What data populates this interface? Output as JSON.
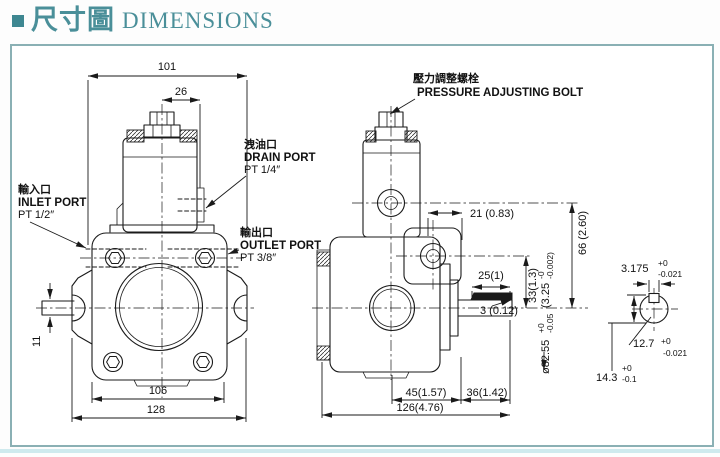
{
  "title": {
    "cjk": "尺寸圖",
    "en": "DIMENSIONS"
  },
  "front_view": {
    "dims": {
      "top_width": "101",
      "valve_offset": "26",
      "shaft_width": "11",
      "body_width": "106",
      "overall_width": "128"
    },
    "labels": {
      "drain": {
        "cjk": "洩油口",
        "en": "DRAIN PORT",
        "thread": "PT 1/4″"
      },
      "inlet": {
        "cjk": "輸入口",
        "en": "INLET PORT",
        "thread": "PT 1/2″"
      },
      "outlet": {
        "cjk": "輸出口",
        "en": "OUTLET PORT",
        "thread": "PT 3/8″"
      }
    }
  },
  "side_view": {
    "labels": {
      "pressure_bolt": {
        "cjk": "壓力調整螺栓",
        "en": "PRESSURE ADJUSTING BOLT"
      }
    },
    "dims": {
      "boss_width": "21 (0.83)",
      "valve_center_height": "66 (2.60)",
      "outlet_center_height": "33(1.3)",
      "key_length": "25(1)",
      "key_height": "3 (0.12)",
      "spigot_dia": {
        "metric": "ø82.55",
        "tol_plus": "+0",
        "tol_minus": "-0.05",
        "inch": "(3.25",
        "inch_tol_plus": "-0",
        "inch_tol_minus": "-0.002)"
      },
      "center_to_flange": "45(1.57)",
      "flange_to_shaft_end": "36(1.42)",
      "overall_length": "126(4.76)"
    }
  },
  "shaft_detail": {
    "key_width": {
      "value": "3.175",
      "tol_plus": "+0",
      "tol_minus": "-0.021"
    },
    "shaft_dia": {
      "value": "12.7",
      "tol_plus": "+0",
      "tol_minus": "-0.021"
    },
    "key_height": {
      "value": "14.3",
      "tol_plus": "+0",
      "tol_minus": "-0.1"
    }
  },
  "colors": {
    "accent": "#4a8f99",
    "frame_border": "#8ab0b4",
    "line": "#1a1a1a"
  }
}
